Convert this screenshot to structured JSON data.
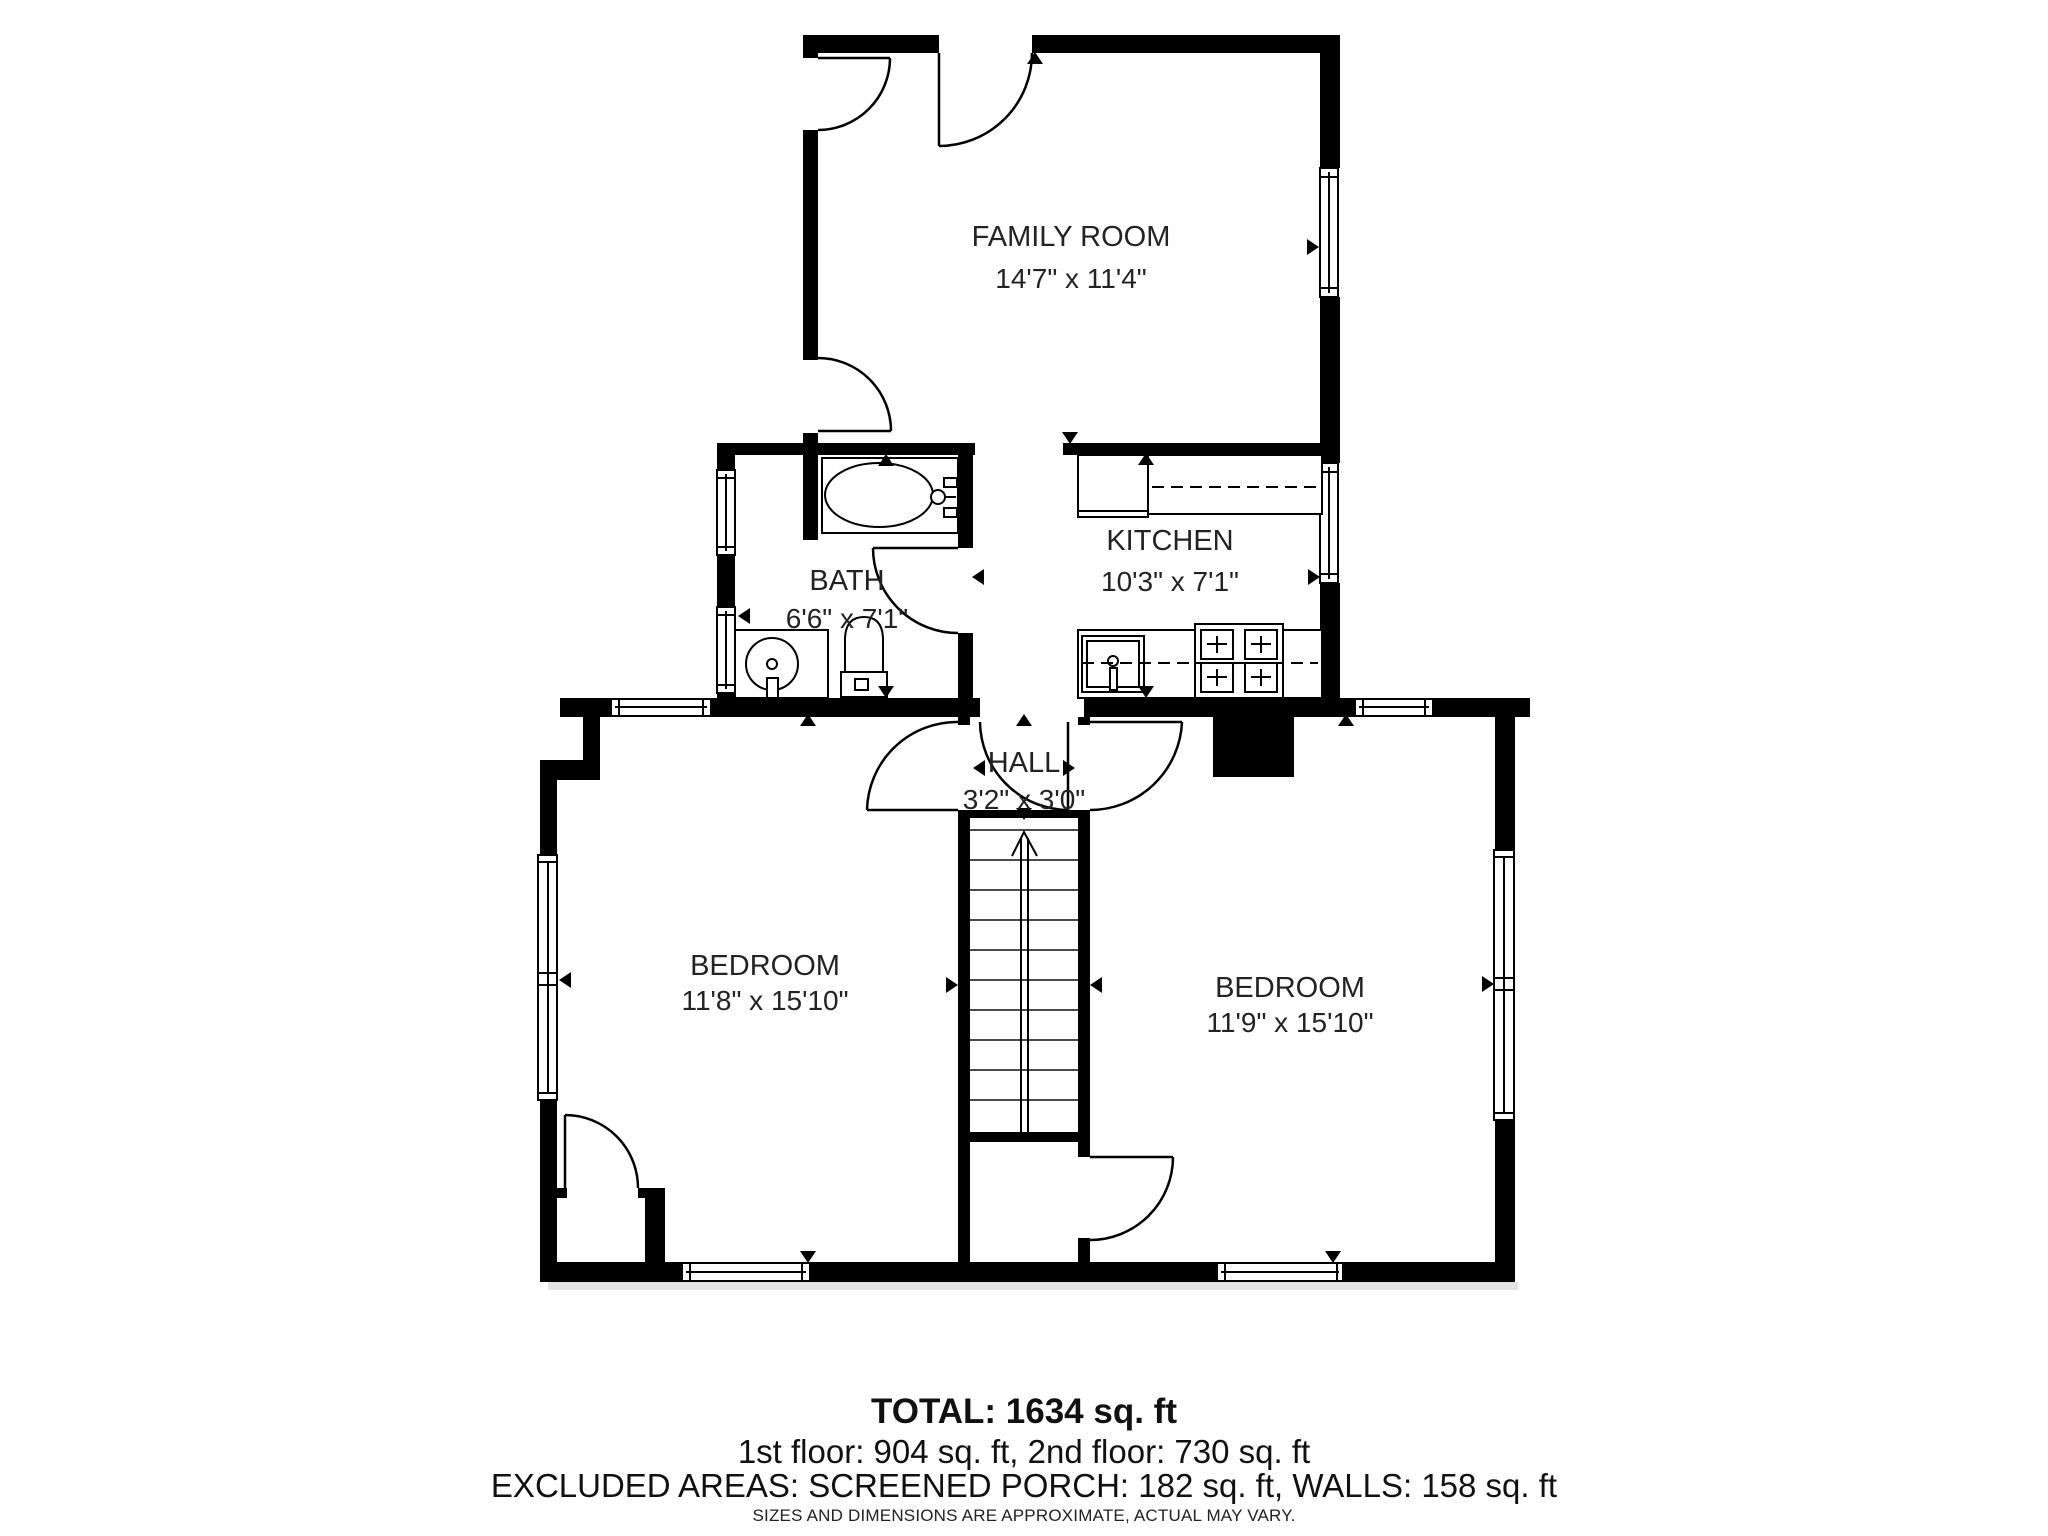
{
  "floorplan": {
    "rooms": [
      {
        "name": "FAMILY ROOM",
        "dims": "14'7\" x 11'4\""
      },
      {
        "name": "KITCHEN",
        "dims": "10'3\" x 7'1\""
      },
      {
        "name": "BATH",
        "dims": "6'6\" x 7'1\""
      },
      {
        "name": "HALL",
        "dims": "3'2\" x 3'0\""
      },
      {
        "name": "BEDROOM",
        "dims": "11'8\" x 15'10\""
      },
      {
        "name": "BEDROOM",
        "dims": "11'9\" x 15'10\""
      }
    ],
    "summary": {
      "total": "TOTAL: 1634 sq. ft",
      "floors": "1st floor: 904 sq. ft, 2nd floor: 730 sq. ft",
      "excluded": "EXCLUDED AREAS: SCREENED PORCH: 182 sq. ft, WALLS: 158 sq. ft",
      "disclaimer": "SIZES AND DIMENSIONS ARE APPROXIMATE, ACTUAL MAY VARY."
    },
    "colors": {
      "wall": "#000000",
      "background": "#ffffff",
      "text": "#232323"
    }
  }
}
